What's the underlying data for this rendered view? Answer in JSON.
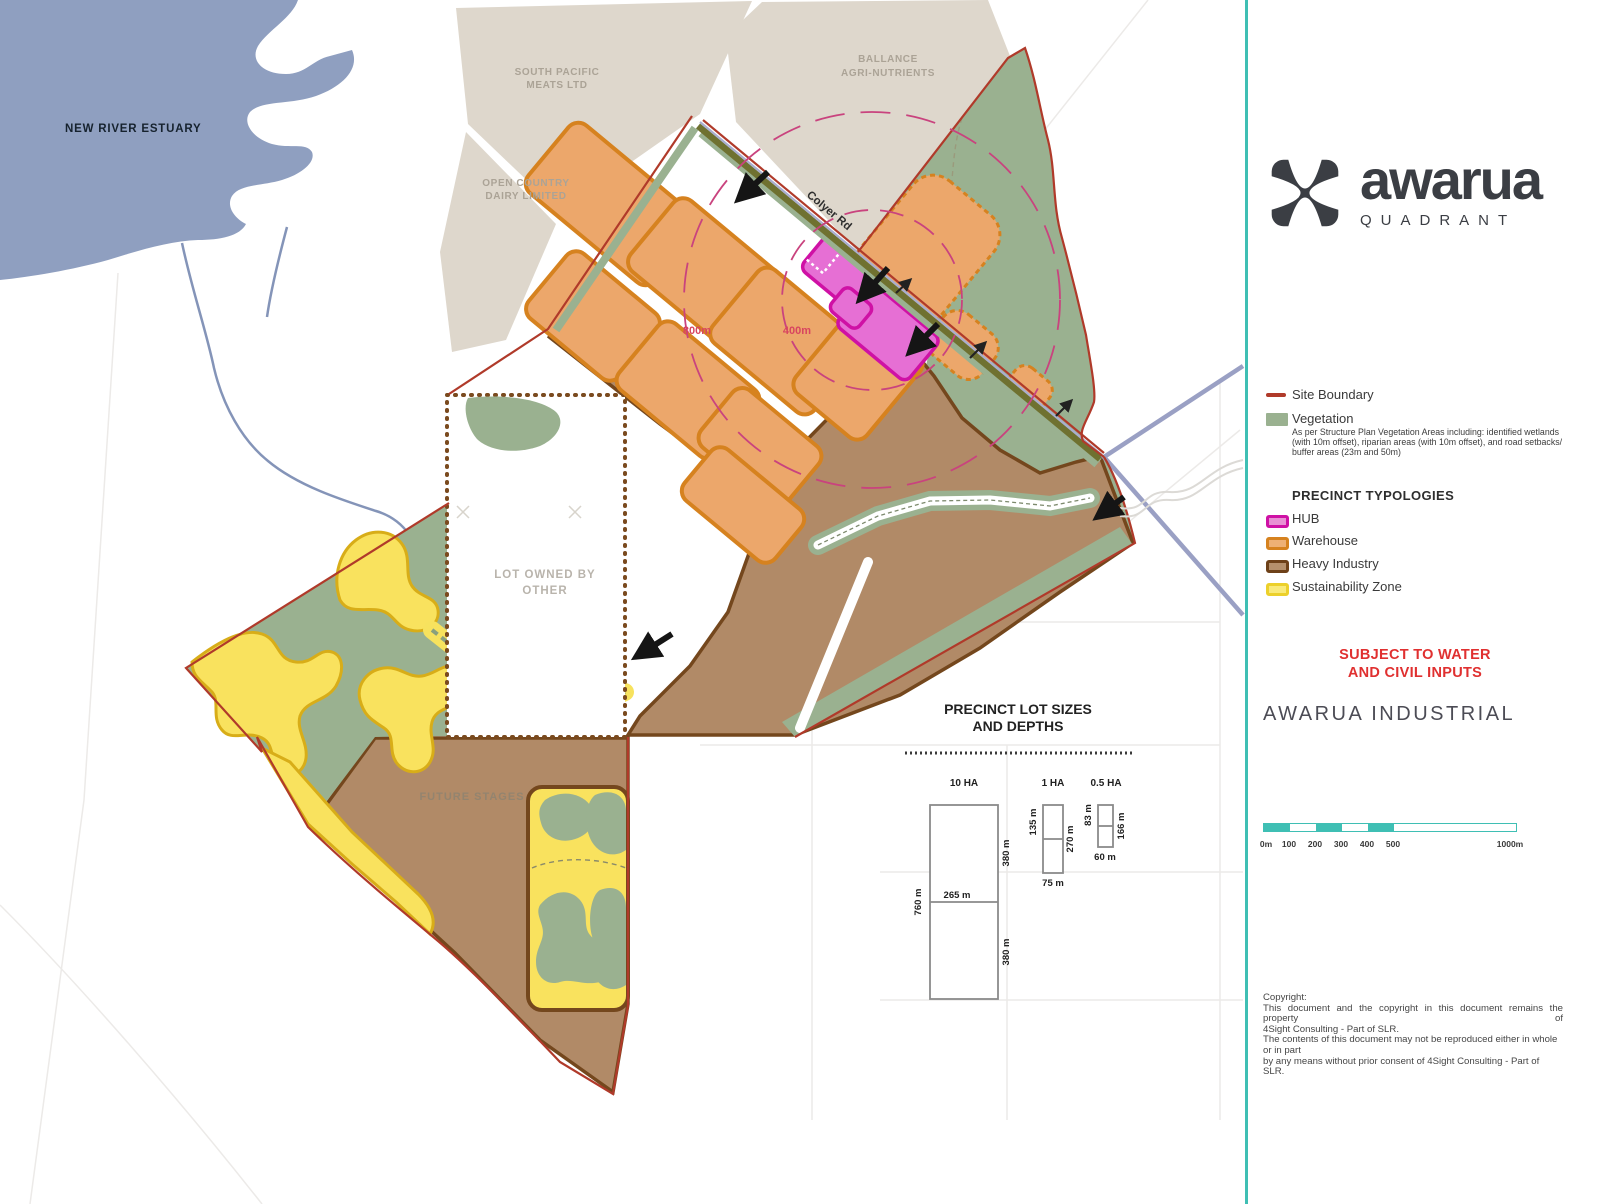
{
  "map": {
    "labels": {
      "estuary": "NEW RIVER ESTUARY",
      "south_pacific_1": "SOUTH PACIFIC",
      "south_pacific_2": "MEATS LTD",
      "open_country_1": "OPEN COUNTRY",
      "open_country_2": "DAIRY LIMITED",
      "ballance_1": "BALLANCE",
      "ballance_2": "AGRI-NUTRIENTS",
      "road": "Colyer Rd",
      "radius_outer": "800m",
      "radius_inner": "400m",
      "lot_other_1": "LOT OWNED BY",
      "lot_other_2": "OTHER",
      "future_stages": "FUTURE STAGES"
    }
  },
  "legend": {
    "site_boundary": "Site Boundary",
    "vegetation": "Vegetation",
    "vegetation_note_1": "As per Structure Plan Vegetation Areas including: identified wetlands",
    "vegetation_note_2": "(with 10m offset), riparian areas (with 10m offset), and road setbacks/",
    "vegetation_note_3": "buffer areas (23m and 50m)",
    "typologies_heading": "PRECINCT TYPOLOGIES",
    "items": [
      {
        "label": "HUB"
      },
      {
        "label": "Warehouse"
      },
      {
        "label": "Heavy Industry"
      },
      {
        "label": "Sustainability Zone"
      }
    ]
  },
  "panel": {
    "logo_text": "awarua",
    "logo_subtext": "QUADRANT",
    "warning_1": "SUBJECT TO WATER",
    "warning_2": "AND CIVIL INPUTS",
    "project_title": "AWARUA INDUSTRIAL",
    "scale_labels": [
      "0m",
      "100",
      "200",
      "300",
      "400",
      "500",
      "1000m"
    ],
    "copyright_lines": [
      "Copyright:",
      "This document and the copyright in this document remains the property of",
      "4Sight Consulting - Part of SLR.",
      "The contents of this document may not be reproduced either in whole or in part",
      "by any means without prior consent of 4Sight Consulting - Part of SLR."
    ]
  },
  "diagram": {
    "title_1": "PRECINCT LOT SIZES",
    "title_2": "AND DEPTHS",
    "lot10": {
      "area": "10 HA",
      "height": "760 m",
      "width": "265 m",
      "depth_top": "380 m",
      "depth_bottom": "380 m"
    },
    "lot1": {
      "area": "1 HA",
      "depth_top": "135 m",
      "height": "270 m",
      "width": "75 m"
    },
    "lot05": {
      "area": "0.5 HA",
      "depth_top": "83 m",
      "height": "166 m",
      "width": "60 m"
    }
  },
  "colors": {
    "site_boundary": "#b03a2a",
    "vegetation": "#9ab190",
    "hub_border": "#cf11a5",
    "hub_fill": "#e66fd4",
    "warehouse_border": "#d6821f",
    "warehouse_fill": "#eca76b",
    "heavy_industry_border": "#74471d",
    "heavy_industry_fill": "#b18a67",
    "sustainability_border": "#e3b81f",
    "sustainability_fill": "#f9e25e",
    "water": "#8f9fc0",
    "existing_parcel": "#ded7cc",
    "road_olive": "#6f7130",
    "rail_purple": "#9aa0c4",
    "radius_pink": "#c9437e",
    "accent_teal": "#3fbfb4",
    "warning_red": "#e03030"
  }
}
